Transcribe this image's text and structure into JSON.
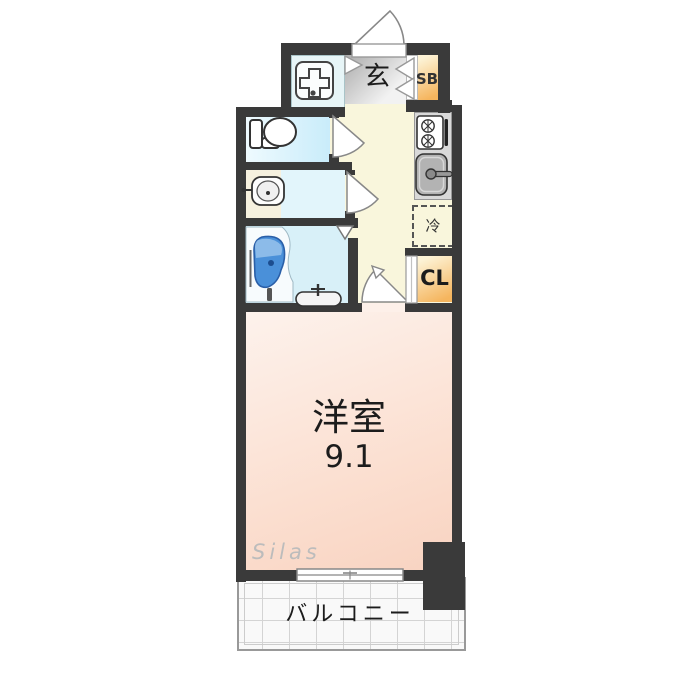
{
  "plan": {
    "type": "apartment-floor-plan",
    "rooms": {
      "entrance": {
        "label": "玄"
      },
      "shoe_box": {
        "label": "SB"
      },
      "refrigerator_space": {
        "label": "冷"
      },
      "closet": {
        "label": "CL"
      },
      "western_room": {
        "label": "洋室",
        "size": "9.1"
      },
      "balcony": {
        "label": "バルコニー"
      }
    },
    "watermark": "Silas",
    "icons": [
      "entrance-door-arc-icon",
      "entrance-step-door-icon",
      "shoe-box-door-icon",
      "washing-machine-pan-icon",
      "toilet-icon",
      "washbasin-icon",
      "bathtub-icon",
      "bath-faucet-icon",
      "bath-counter-sink-icon",
      "bath-folding-door-icon",
      "stove-icon",
      "kitchen-sink-icon",
      "room-door-arc-icon",
      "closet-folding-door-icon",
      "sliding-window-icon"
    ],
    "colors": {
      "wall": "#3a3a3a",
      "western_room": "#fbdecf",
      "hallway_kitchen": "#f9f6dc",
      "toilet_room": "#cdeefb",
      "bathroom": "#d8f0f8",
      "washing_area": "#e7f5f7",
      "entrance_floor": "#cfcfcf",
      "storage_orange": "#f5b55e",
      "bathtub_blue": "#3f86d4",
      "balcony_grid": "#d4d4d4",
      "watermark_gray": "#bcbcbc"
    }
  }
}
